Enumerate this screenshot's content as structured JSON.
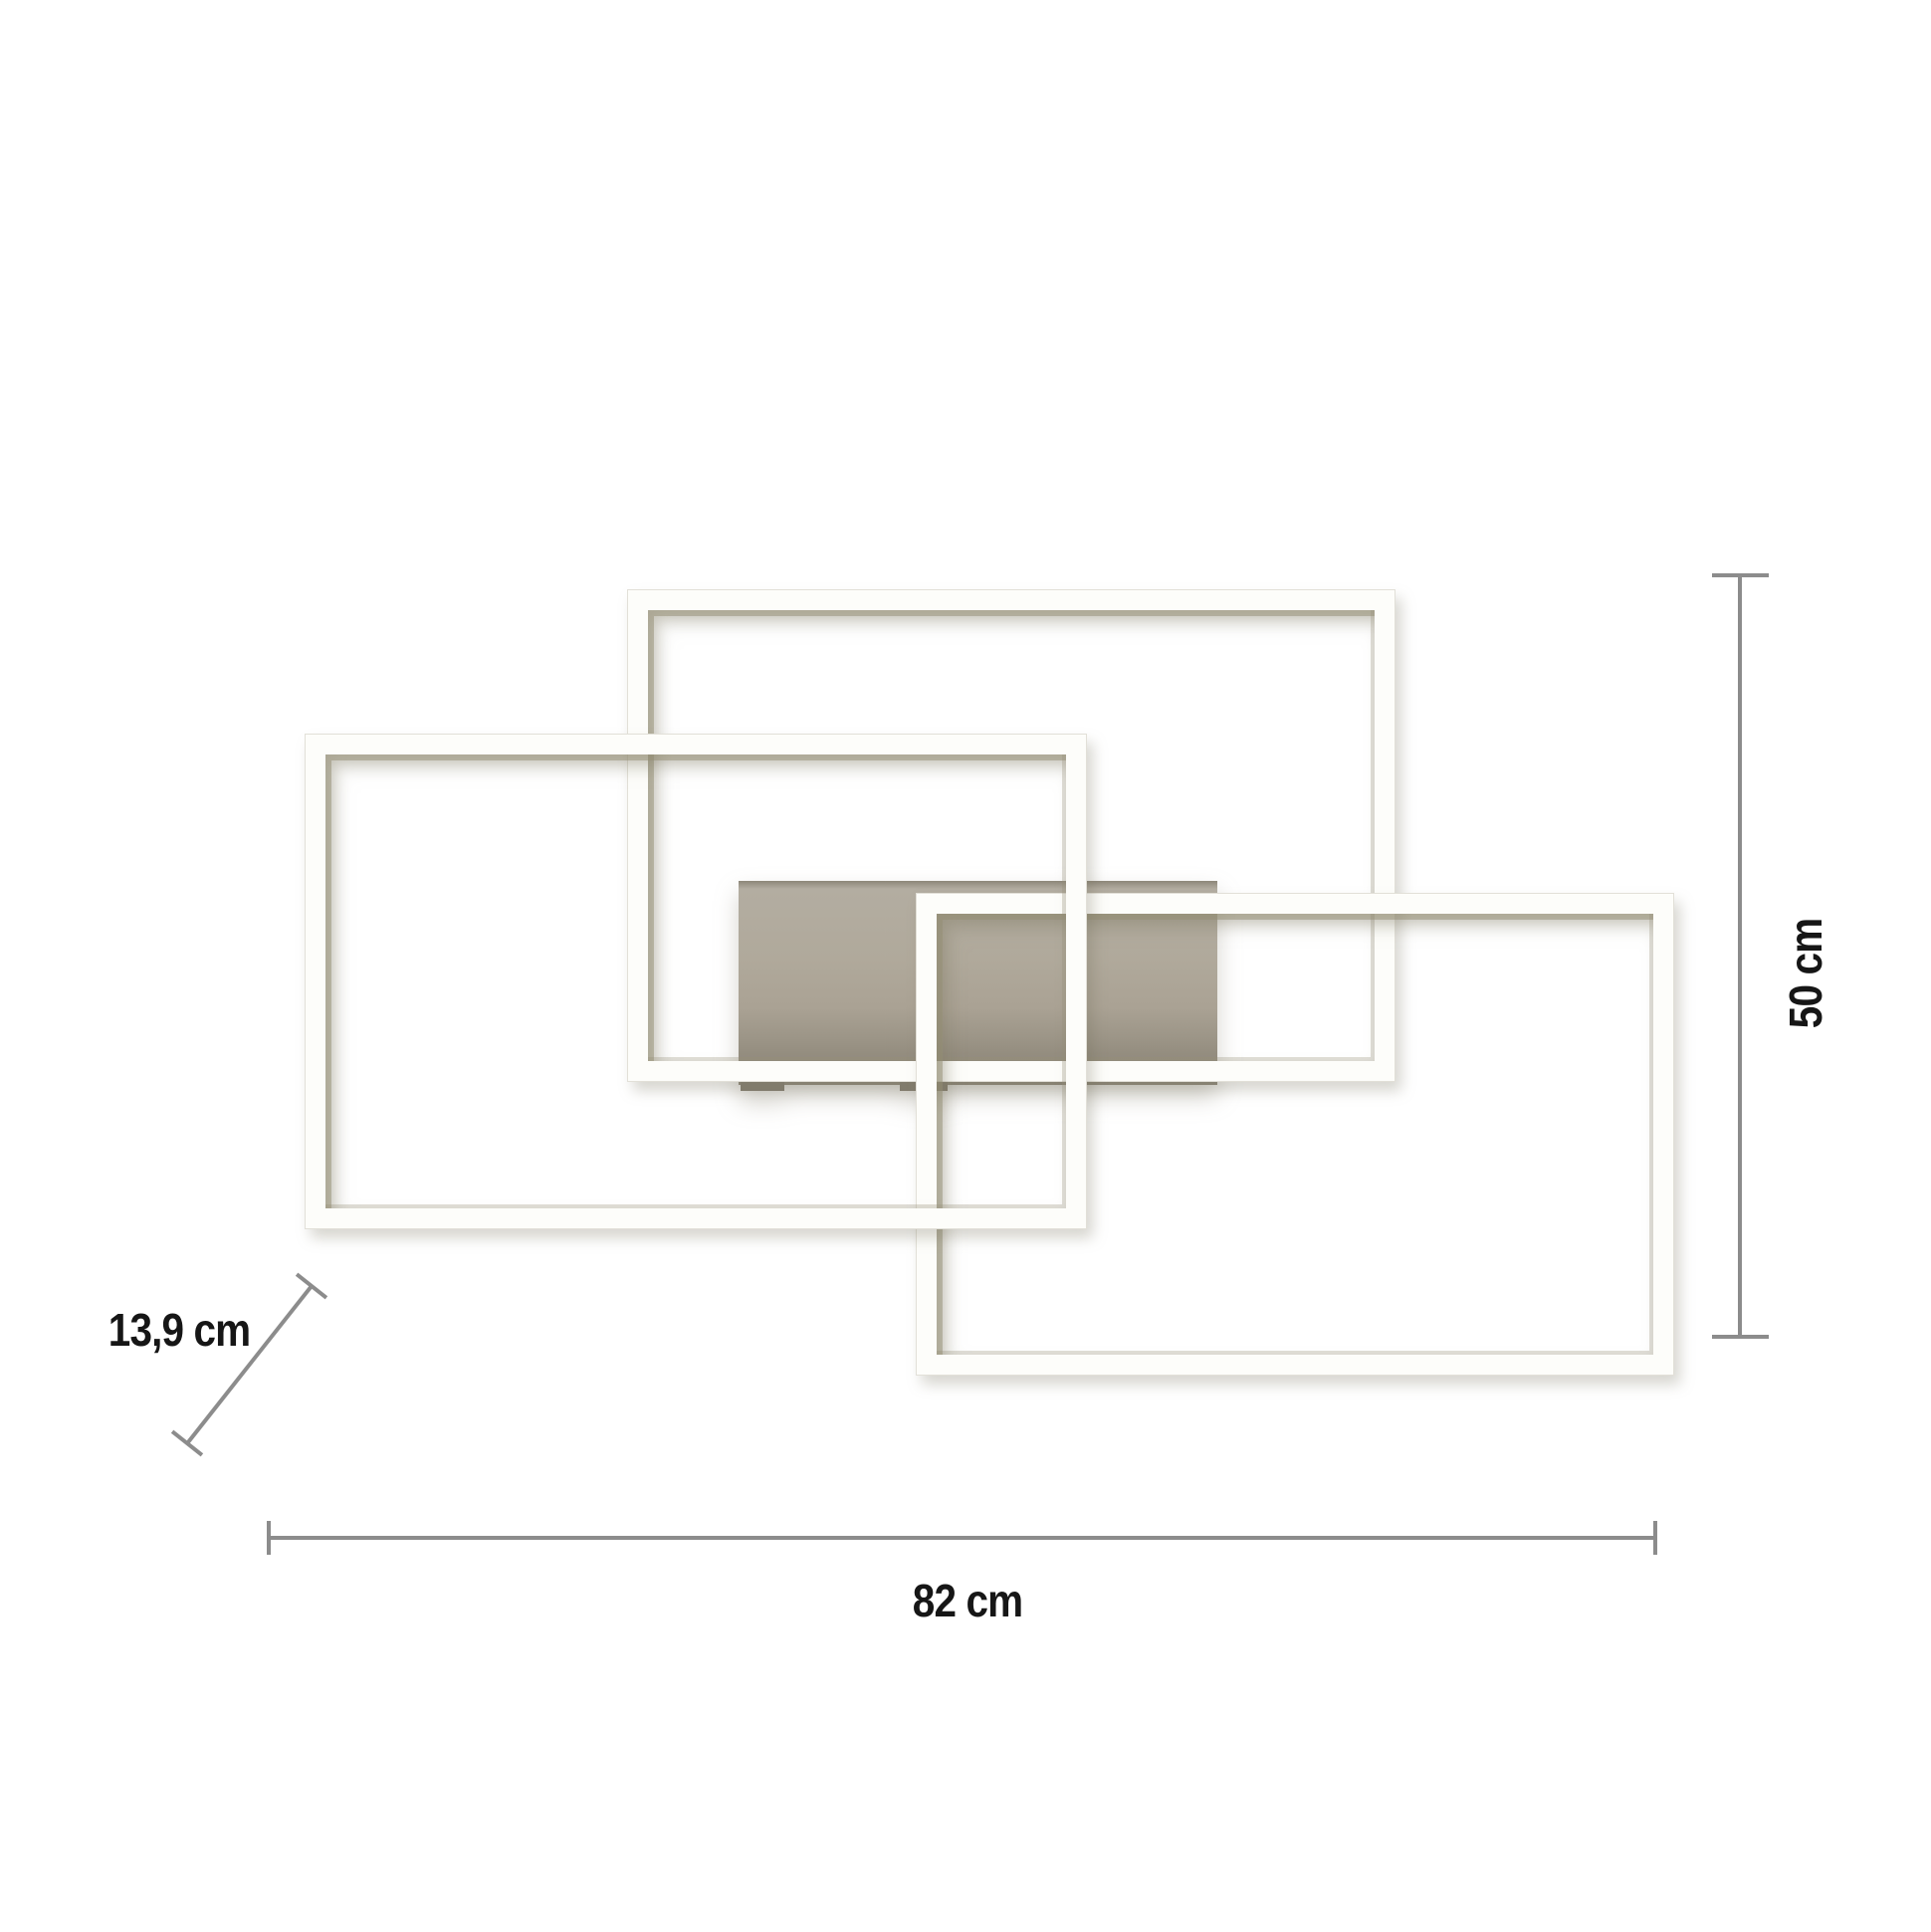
{
  "page": {
    "title": "LED ceiling light — dimension diagram",
    "background": "#ffffff"
  },
  "fixture": {
    "description": "Ceiling light made of three overlapping rectangular LED frames on a rectangular mounting plate",
    "frames": [
      "top-frame",
      "left-frame",
      "right-frame"
    ],
    "mount": "canopy-plate"
  },
  "dimensions": {
    "width": {
      "label": "82 cm",
      "orientation": "horizontal"
    },
    "height": {
      "label": "50 cm",
      "orientation": "vertical"
    },
    "depth": {
      "label": "13,9 cm",
      "orientation": "diagonal"
    }
  },
  "colors": {
    "background": "#ffffff",
    "frame_white": "#fdfdfa",
    "frame_inner_shadow": "#948d73",
    "plate_gray": "#aaa294",
    "plate_dark": "#8f897b",
    "dimension_line": "#8c8c8c",
    "label_text": "#161616"
  }
}
